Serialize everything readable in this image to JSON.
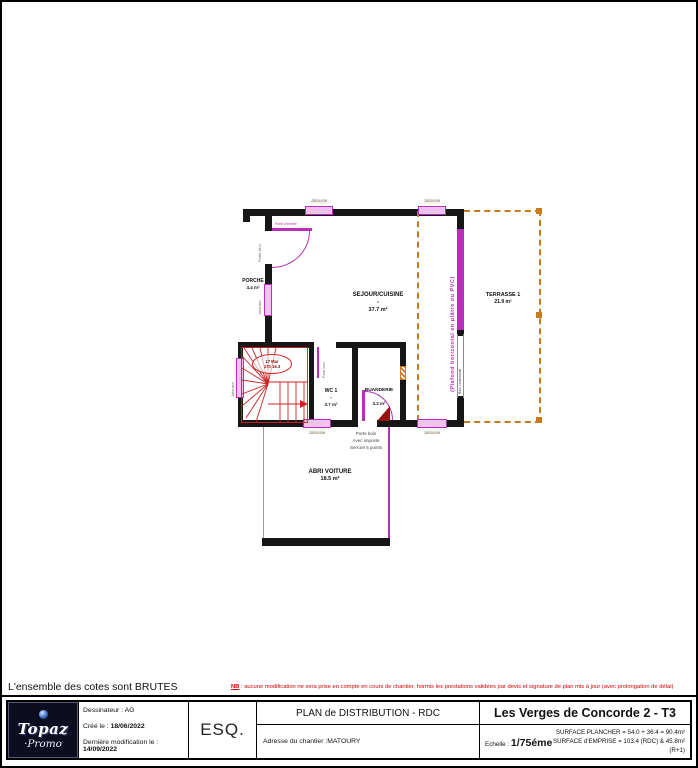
{
  "footer": {
    "cotes_note": "L'ensemble des cotes sont BRUTES",
    "nb_label": "NB",
    "nb_text": " : aucune modification ne sera prise en compte en cours de chantier, hormis les prestations validées par devis et signature de plan mis à jour (avec prolongation de délai)"
  },
  "title_block": {
    "logo_line1": "Topaz",
    "logo_line2": "·Promo",
    "dessinateur_label": "Dessinateur : ",
    "dessinateur_value": "AG",
    "cree_label": "Créé le : ",
    "cree_date": "18/06/2022",
    "modif_label": "Dernière modification le : ",
    "modif_date": "14/09/2022",
    "phase": "ESQ.",
    "plan_title": "PLAN de DISTRIBUTION - RDC",
    "adresse_label": "Adresse du chantier : ",
    "adresse_value": "MATOURY",
    "project_title": "Les Verges de Concorde 2 - T3",
    "echelle_label": "Echelle : ",
    "echelle_value": "1/75éme",
    "surface_plancher": "SURFACE PLANCHER = 54.0 + 36.4 = 90.4m²",
    "surface_emprise": "SURFACE d'EMPRISE = 103.4 (RDC) & 45.8m² (R+1)"
  },
  "plan": {
    "rooms": {
      "porche": {
        "name": "PORCHE",
        "area": "4.4 m²"
      },
      "sejour": {
        "name": "SEJOUR/CUISINE",
        "sep": "-",
        "area": "37.7 m²"
      },
      "terrasse": {
        "name": "TERRASSE 1",
        "area": "21.9 m²"
      },
      "wc": {
        "name": "WC 1",
        "sep": "-",
        "area": "3.7 m²"
      },
      "buanderie": {
        "name": "BUANDERIE",
        "sep": "-",
        "area": "3.2 m²"
      },
      "abri": {
        "name": "ABRI VOITURE",
        "area": "18.5 m²"
      }
    },
    "labels": {
      "jalousie": "Jalousie",
      "porte_bois": "Porte bois",
      "avec_imposte": "Avec imposte",
      "serrure": "Serrure 5 points",
      "plafond": "(Plafond horizontal en plâtre ou PVC)",
      "porte_entree": "Porte d'entrée",
      "porte_alu": "Porte ALU",
      "baie": "Baie coulissante",
      "stair_line1": "17 Mar",
      "stair_line2": "170 16.3"
    },
    "colors": {
      "wall": "#161616",
      "menuiserie": "#b72fb7",
      "terrasse_dash": "#c87a1e",
      "stairs": "#cc2222",
      "note_red": "#cc0000"
    }
  }
}
